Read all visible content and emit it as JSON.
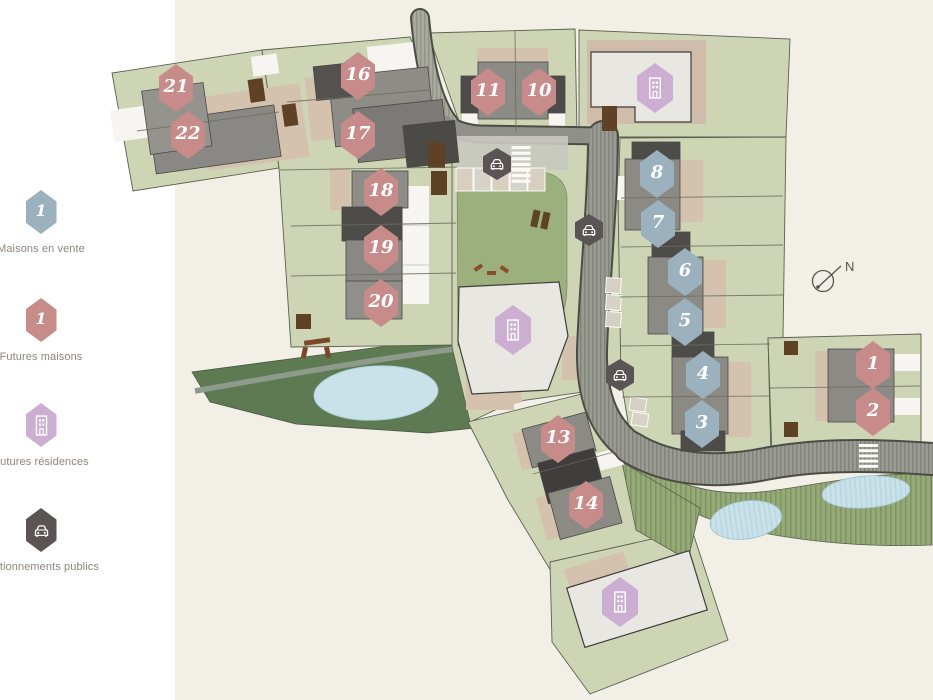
{
  "legend": {
    "items": [
      {
        "label": "Maisons en vente",
        "badge": "1",
        "icon": "hex-blue"
      },
      {
        "label": "Futures maisons",
        "badge": "1",
        "icon": "hex-pink"
      },
      {
        "label": "Futures résidences",
        "icon": "building-icon"
      },
      {
        "label": "Stationnements publics",
        "icon": "car-icon"
      }
    ]
  },
  "map": {
    "north_label": "N",
    "lots": {
      "l1": "1",
      "l2": "2",
      "l3": "3",
      "l4": "4",
      "l5": "5",
      "l6": "6",
      "l7": "7",
      "l8": "8",
      "l10": "10",
      "l11": "11",
      "l13": "13",
      "l14": "14",
      "l16": "16",
      "l17": "17",
      "l18": "18",
      "l19": "19",
      "l20": "20",
      "l21": "21",
      "l22": "22"
    }
  },
  "colors": {
    "sale_blue": "#9bb1be",
    "future_pink": "#c78b8a",
    "residence_purple": "#cbaed1",
    "parking_dark": "#5a5554",
    "parcel_green": "#cdd5b4",
    "woodland_green": "#5d7a52",
    "park_green": "#9cb07e",
    "water_blue": "#c9e2e9",
    "map_background": "#f2efe7"
  }
}
